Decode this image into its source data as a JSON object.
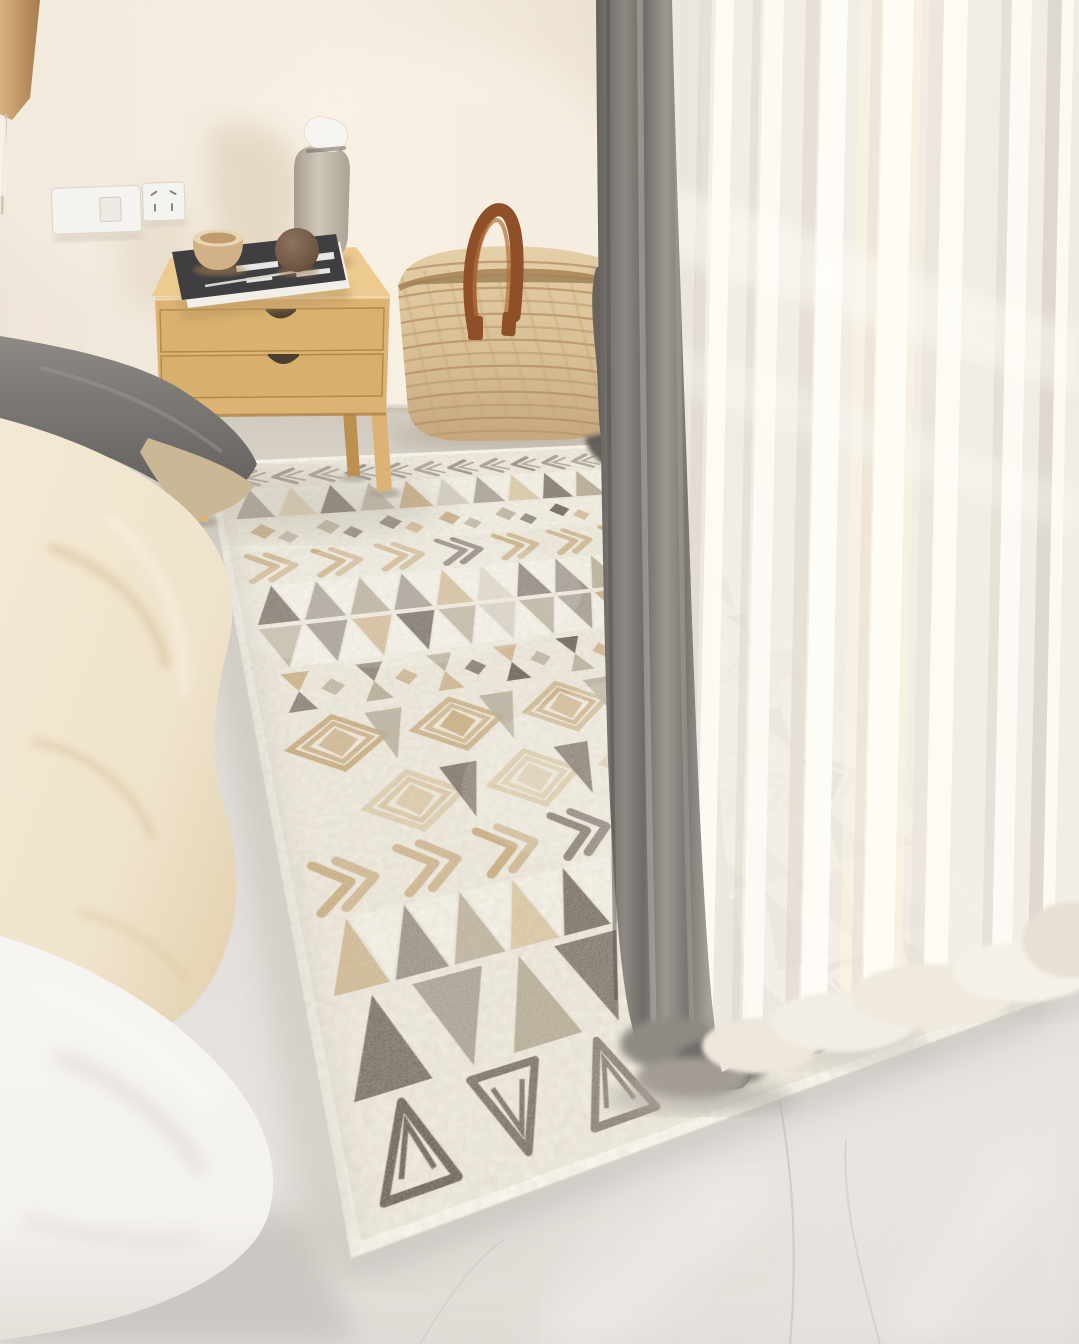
{
  "scene": {
    "type": "interior-photograph",
    "setting": "Sunlit bedroom corner with a geometric boho area rug between a bed and a sheer-curtained window",
    "objects": [
      {
        "name": "area-rug",
        "description": "large ivory boho rug with bands of triangles, concentric diamonds, chevron arrows and zigzag borders in grey, taupe, tan and brown"
      },
      {
        "name": "bed",
        "description": "bed at left with grey pillow, cream knit blanket, white duvet and light-wood base"
      },
      {
        "name": "nightstand",
        "description": "light wood two-drawer nightstand with splayed legs standing on the rug edge"
      },
      {
        "name": "book",
        "description": "dark hardcover book with white cover graphics lying on the nightstand"
      },
      {
        "name": "bowl",
        "description": "two-tone beige ceramic bowl on the book"
      },
      {
        "name": "sphere",
        "description": "brown wooden decorative ball"
      },
      {
        "name": "vase",
        "description": "grey-beige bottle vase with tilted white lid"
      },
      {
        "name": "woven-basket",
        "description": "natural woven basket with brown leather loop handle and dark grey throw draped over its rim"
      },
      {
        "name": "grey-curtain",
        "description": "grey drape pooling on the floor"
      },
      {
        "name": "sheer-curtains",
        "description": "white translucent sheers glowing with window light"
      },
      {
        "name": "wall-switch-outlet",
        "description": "white light-switch plate and socket plate on the wall"
      },
      {
        "name": "wall-lamp",
        "description": "wooden lamp shade cropped at the upper-left corner"
      },
      {
        "name": "floor",
        "description": "pale grey polished marble floor with faint veins"
      }
    ]
  },
  "palette": {
    "wall": "#ece3d5",
    "wall_bright": "#f7f0e4",
    "wall_dark": "#d3c8b9",
    "wall_shadow": "#d6c7b0",
    "floor": "#dedad4",
    "floor_warm": "#d5cdc2",
    "floor_shadow": "#c6c2bd",
    "floor_bright": "#efedea",
    "vein": "#c0bcb8",
    "rug_base": "#ece6d9",
    "rug_white": "#f8f5ec",
    "rug_grey": "#8b8177",
    "rug_taupe": "#aca089",
    "rug_tan": "#c2a372",
    "rug_tan_light": "#d7c29c",
    "rug_brown": "#5d5147",
    "rug_dark": "#4c443c",
    "wood": "#ddb375",
    "wood_top": "#ecca90",
    "wood_dark": "#c0914f",
    "notch": "#4a3e2e",
    "book_cover": "#3f3e40",
    "book_pages": "#f2efe8",
    "bowl_body": "#d3b187",
    "bowl_rim": "#e9d6b4",
    "sphere_brown": "#6e5542",
    "vase_body": "#b9afa1",
    "vase_light": "#cfc7b9",
    "cap_white": "#f6f4f0",
    "basket": "#dcc49c",
    "basket_dark": "#c3a476",
    "basket_line": "#b08c5e",
    "leather": "#8f4f28",
    "leather_light": "#b46f38",
    "fabric_grey": "#59544f",
    "curtain_grey": "#8b8681",
    "curtain_grey_dark": "#66625e",
    "curtain_grey_light": "#aba49d",
    "sheer": "#f3efe7",
    "sheer_light": "#fffdf7",
    "sheer_shade": "#d9d2c7",
    "sheer_warm": "#fcf3e2",
    "pillow_grey": "#716d69",
    "pillow_grey_light": "#8d8985",
    "blanket_cream": "#efe3cb",
    "blanket_shadow": "#d6c29c",
    "duvet_white": "#f4f2ee",
    "duvet_shadow": "#d9d5cf",
    "bed_wood": "#c9995f",
    "lamp_tan": "#d9b080",
    "lamp_dark": "#a87c4c",
    "outlet_white": "#f5f3ef",
    "outlet_edge": "#d8d1c5"
  },
  "rug": {
    "rows": [
      {
        "type": "zigzag",
        "h": 52,
        "color": "rug_grey"
      },
      {
        "type": "triangles",
        "h": 84,
        "colors": [
          "rug_grey",
          "rug_tan_light",
          "rug_brown",
          "rug_taupe",
          "rug_tan",
          "rug_grey"
        ]
      },
      {
        "type": "blocks",
        "h": 78,
        "colors": [
          "rug_tan",
          "rug_taupe",
          "rug_brown"
        ]
      },
      {
        "type": "arrows",
        "h": 74,
        "color": "rug_tan"
      },
      {
        "type": "triangles",
        "h": 88,
        "colors": [
          "rug_brown",
          "rug_grey",
          "rug_taupe",
          "rug_grey",
          "rug_tan",
          "rug_taupe"
        ]
      },
      {
        "type": "triangles_down",
        "h": 88,
        "colors": [
          "rug_taupe",
          "rug_grey",
          "rug_tan",
          "rug_brown",
          "rug_taupe",
          "rug_grey"
        ]
      },
      {
        "type": "hourglass",
        "h": 82,
        "colors": [
          "rug_tan",
          "rug_brown",
          "rug_taupe"
        ]
      },
      {
        "type": "diamonds",
        "h": 108,
        "color": "rug_tan",
        "accent": "rug_taupe"
      },
      {
        "type": "diamonds",
        "h": 108,
        "color": "rug_tan_light",
        "accent": "rug_brown",
        "offset": 76
      },
      {
        "type": "arrows",
        "h": 78,
        "color": "rug_tan"
      },
      {
        "type": "triangles",
        "h": 92,
        "colors": [
          "rug_tan",
          "rug_grey",
          "rug_taupe",
          "rug_tan_light",
          "rug_brown",
          "rug_grey"
        ]
      },
      {
        "type": "bigtriangles",
        "h": 108,
        "colors": [
          "rug_brown",
          "rug_grey",
          "rug_taupe",
          "rug_brown",
          "rug_grey",
          "rug_dark"
        ]
      },
      {
        "type": "outlined",
        "h": 96,
        "color": "rug_brown"
      }
    ]
  }
}
